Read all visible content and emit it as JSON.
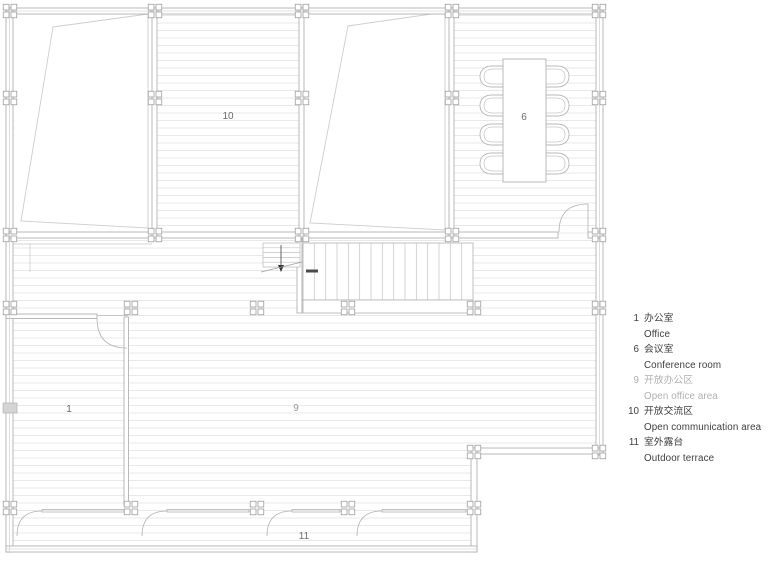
{
  "plan": {
    "rooms": [
      {
        "number": "1",
        "name": "Office"
      },
      {
        "number": "6",
        "name": "Conference room"
      },
      {
        "number": "9",
        "name": "Open office area"
      },
      {
        "number": "10",
        "name": "Open communication area"
      },
      {
        "number": "11",
        "name": "Outdoor terrace"
      }
    ]
  },
  "legend": {
    "items": [
      {
        "number": "1",
        "zh": "办公室",
        "en": "Office"
      },
      {
        "number": "6",
        "zh": "会议室",
        "en": "Conference room"
      },
      {
        "number": "9",
        "zh": "开放办公区",
        "en": "Open office area"
      },
      {
        "number": "10",
        "zh": "开放交流区",
        "en": "Open communication area"
      },
      {
        "number": "11",
        "zh": "室外露台",
        "en": "Outdoor terrace"
      }
    ]
  },
  "colors": {
    "wall": "#a9a9a9",
    "hatch": "#e8e8e8",
    "furniture": "#b5b5b5",
    "room_label": "#6a6a6a",
    "muted_label": "#9b9b9b",
    "legend_text": "#3e3e3e",
    "legend_muted": "#b0b0b0"
  }
}
